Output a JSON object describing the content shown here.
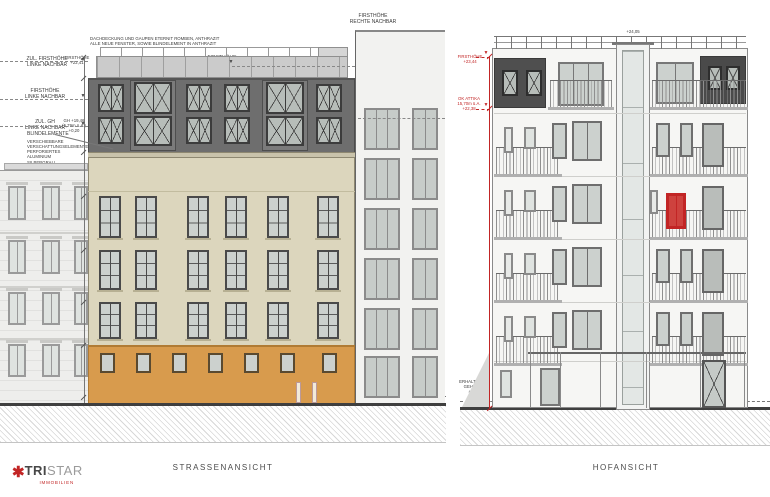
{
  "colors": {
    "anthracite": "#6e6e6e",
    "anthracite_bay": "#7b7b7b",
    "dormer_dark": "#4f4f4f",
    "roof_band": "#cbcbcb",
    "cream": "#dcd6bd",
    "cornice": "#c9c3ab",
    "orange": "#d89b4d",
    "orange_dark": "#b07b34",
    "glass": "#b7bdb9",
    "glass_light": "#ccd1ce",
    "frame": "#3c3c3c",
    "neighbor_left": "#eeeeec",
    "neighbor_right": "#f2f2f0",
    "hof_facade": "#f6f6f4",
    "ground": "#3f3f3f",
    "red": "#c22525"
  },
  "logo": {
    "star": "✱",
    "brand_bold": "TRI",
    "brand_light": "STAR",
    "subtitle": "IMMOBILIEN"
  },
  "drawings": {
    "left": {
      "caption": "STRASSENANSICHT",
      "annotations": {
        "roof_note": "DACHDECKUNG UND GAUPEN ETERNIT ROMBEN, ANTHRAZIT\nALLE NEUE FENSTER, SOWIE BLINDELEMENT IN ANTHRAZIT",
        "zul_firsthoehe_linke": "ZUL. FIRSTHÖHE\nLINKE NACHBAR",
        "firsthoehe_level": "FIRSTHÖHE\n+22,41",
        "firsthoehe_linke": "FIRSTHÖHE\nLINKE NACHBAR",
        "zul_gh_linke": "ZUL. GH\nLINKE NACHBAR",
        "gh_level": "GH +19,46\n(5,79m ü.A.)\n+0,20",
        "blindelemente": "BLINDELEMENTE",
        "verschattung": "VERSCHIEBBARE\nVERSCHATTUNGSELEMENTE\nPERFORIERTES ALUMINIUM\nSILBERGRAU",
        "firsthoehe_main": "FIRSTHÖHE\n+23,44",
        "firsthoehe_rechte": "FIRSTHÖHE\nRECHTE NACHBAR",
        "gh_rechte": "GH\nRECHTE NACHBAR",
        "sidewalk": "ERHALTEN 7,5\nGEH WEG\n±0,00"
      }
    },
    "right": {
      "caption": "HOFANSICHT",
      "annotations": {
        "firsthoehe": "FIRSTHÖHE\n+23,44",
        "ok_attika": "OK ATTIKA\n15,70m ü.A.\n+22,38",
        "lift_dim": "+24,05",
        "flugdach": "FLUGDACH\nSTAHLKONSTR. VERZINKT",
        "wand_note": "Wand bis zur\nBodenmarkierung",
        "sidewalk": "ERHALTEN 7,5\nGEH WEG\n±0,00"
      }
    }
  }
}
